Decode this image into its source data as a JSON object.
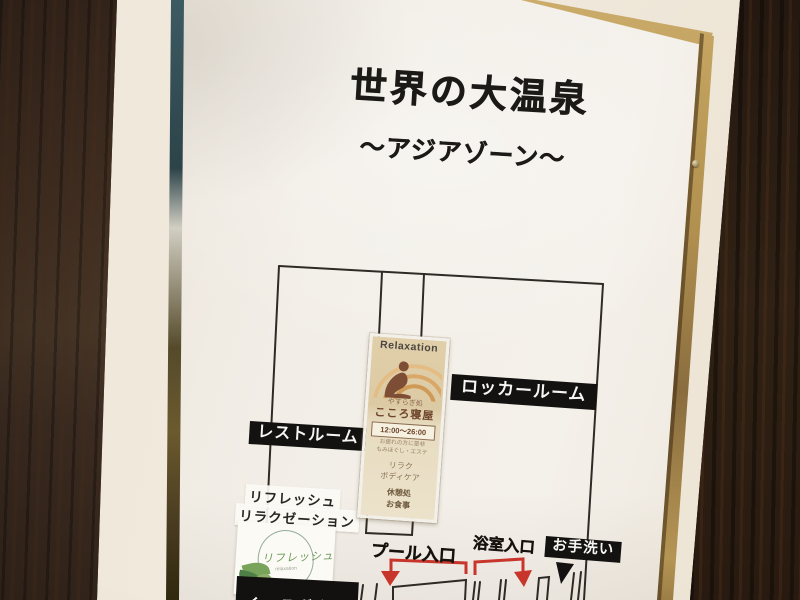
{
  "photo": {
    "poster": {
      "title": "世界の大温泉",
      "subtitle": "～アジアゾーン～"
    },
    "map_labels": {
      "rest_room": "レストルーム",
      "locker_room": "ロッカールーム",
      "pool_entrance": "プール入口",
      "bath_entrance": "浴室入口",
      "toilet": "お手洗い",
      "cutoff_bottom": "くつろぎ広場"
    },
    "refresh": {
      "line1": "リフレッシュ",
      "line2": "リラクゼーション",
      "logo_script": "リフレッシュ",
      "logo_sub": "relaxation"
    },
    "relaxation_sign": {
      "header": "Relaxation",
      "place_small": "やすらぎ処",
      "place_name": "こころ寝屋",
      "hours": "12:00～26:00",
      "note1": "お疲れの方に是非",
      "note2": "もみほぐし・エステ",
      "svc1": "リラク",
      "svc2": "ボディケア",
      "svc3": "休憩処",
      "svc4": "お食事"
    },
    "colors": {
      "arrow_red": "#c8352a",
      "label_black": "#141210",
      "poster_white": "#f2eee7",
      "wood_brown": "#3c2a1f",
      "gold_frame": "#b2914f",
      "sign_beige": "#e0cfa9",
      "leaf_green": "#6a9a5a"
    }
  }
}
